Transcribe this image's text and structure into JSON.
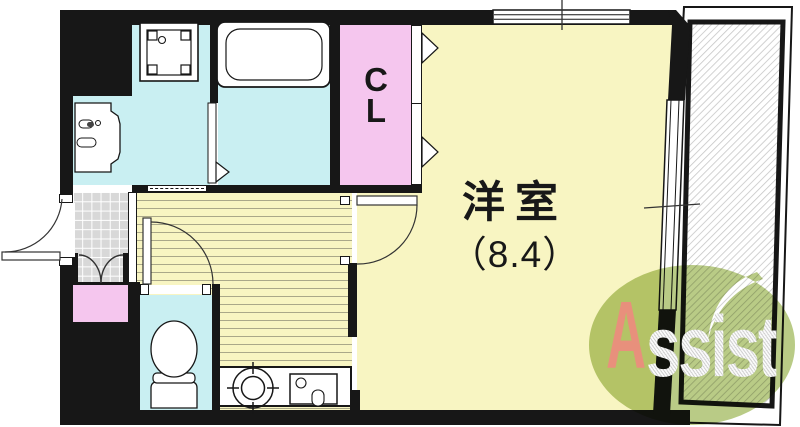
{
  "plan": {
    "type": "apartment-floor-plan",
    "rooms": {
      "main_room": {
        "name": "洋室",
        "size": "（8.4）"
      },
      "closet": {
        "line1": "C",
        "line2": "L"
      }
    },
    "colors": {
      "wall": "#171717",
      "room_yellow": "#f8f5c2",
      "wet_area_cyan": "#c9eff2",
      "closet_pink": "#f5c6ee",
      "entrance_tile_gray": "#d8d8d8",
      "logo_green": "#a9bf6b",
      "logo_red": "#e8907c"
    }
  },
  "logo": {
    "initial": "A",
    "rest": "ssist",
    "brand": "Assist"
  }
}
